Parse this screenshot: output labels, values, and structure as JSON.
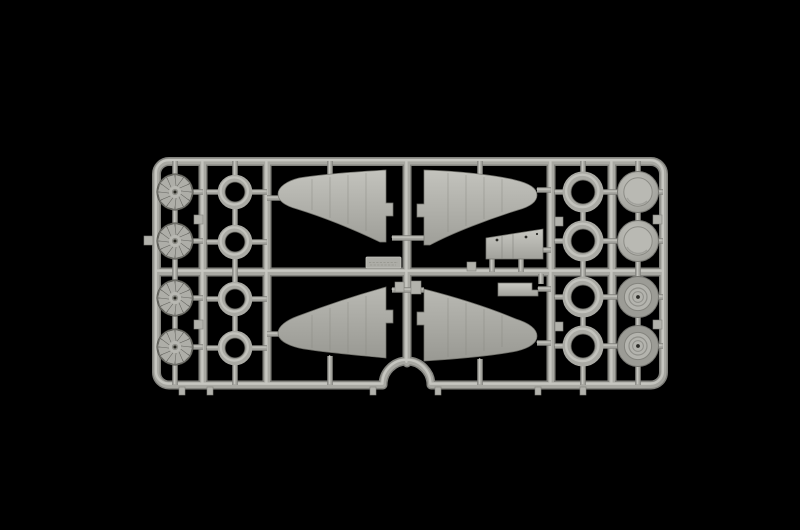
{
  "meta": {
    "subject": "photograph of a light-grey injection-moulded model aircraft kit sprue (parts tree) on a black background",
    "orientation": "horizontal sprue, four rows of round parts on each side, four wing halves in the centre"
  },
  "colors": {
    "background": "#000000",
    "rail_base": "#a8a8a2",
    "rail_light": "#cbcbc5",
    "rail_dark": "#83837e",
    "part_base": "#b2b2ac",
    "part_light": "#c7c7c1",
    "part_shadow": "#82827c",
    "recess_dark": "#45453f",
    "hole_dark": "#1f1f1c",
    "wing_top": "#c2c2bc",
    "wing_bottom": "#9e9e98",
    "vignette": "rgba(0,0,0,0.55)"
  },
  "sprue": {
    "material": "grey polystyrene",
    "rows_y": [
      192,
      241,
      298,
      347
    ],
    "molded_parts": [
      {
        "name": "radial-engine-face",
        "symbol": "sym-engine",
        "count": 4,
        "positions": [
          [
            175,
            192
          ],
          [
            175,
            241
          ],
          [
            175,
            298
          ],
          [
            175,
            347
          ]
        ]
      },
      {
        "name": "cowl-ring-small",
        "symbol": "sym-ring-small",
        "count": 4,
        "positions": [
          [
            235,
            192
          ],
          [
            235,
            242
          ],
          [
            235,
            299
          ],
          [
            235,
            348
          ]
        ]
      },
      {
        "name": "cowl-ring-large",
        "symbol": "sym-ring-large",
        "count": 4,
        "positions": [
          [
            583,
            192
          ],
          [
            583,
            241
          ],
          [
            583,
            297
          ],
          [
            583,
            346
          ]
        ]
      },
      {
        "name": "wheel-disc-smooth",
        "symbol": "sym-hubcap",
        "count": 2,
        "positions": [
          [
            638,
            192
          ],
          [
            638,
            241
          ]
        ]
      },
      {
        "name": "wheel-disc-hub",
        "symbol": "sym-wheel",
        "count": 2,
        "positions": [
          [
            638,
            297
          ],
          [
            638,
            346
          ]
        ]
      }
    ],
    "unique_parts": [
      "upper-wing-left",
      "upper-wing-right",
      "lower-wing-left",
      "lower-wing-right",
      "cockpit-floor",
      "access-hatch",
      "part-number-tag"
    ],
    "gate_tab_xs": [
      182,
      210,
      373,
      438,
      538,
      583
    ]
  }
}
